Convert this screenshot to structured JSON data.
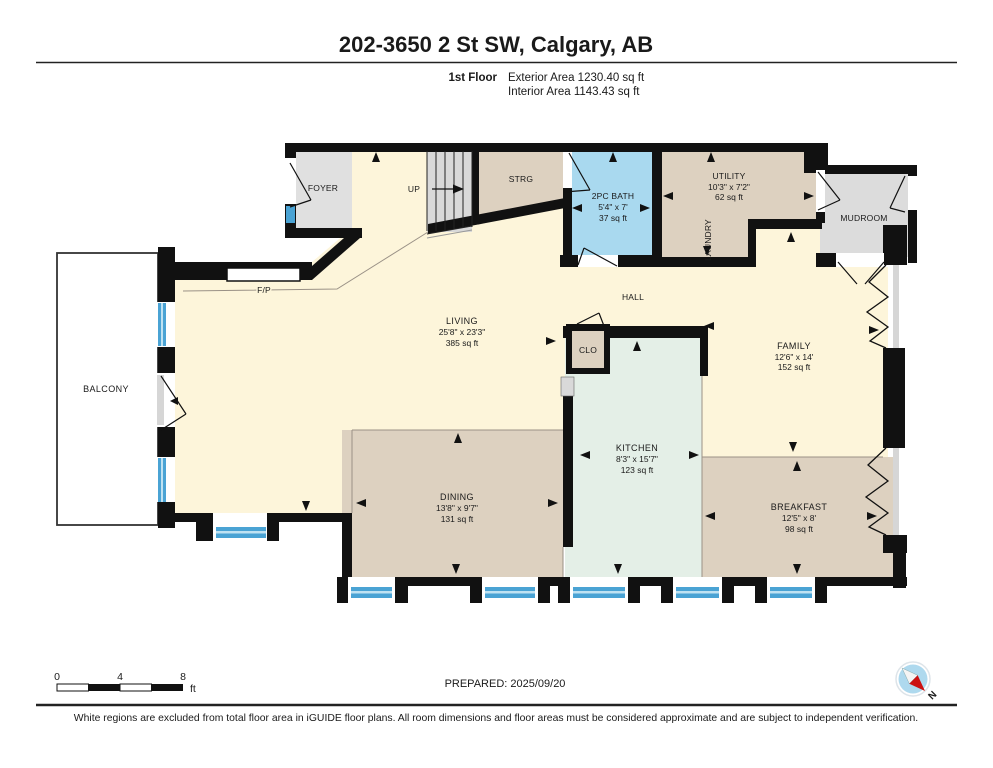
{
  "header": {
    "title": "202-3650 2 St SW, Calgary, AB",
    "floor_label": "1st Floor",
    "exterior_area": "Exterior Area 1230.40 sq ft",
    "interior_area": "Interior Area 1143.43 sq ft"
  },
  "rooms": {
    "foyer": {
      "name": "FOYER"
    },
    "up": {
      "name": "UP"
    },
    "strg": {
      "name": "STRG"
    },
    "bath": {
      "name": "2PC BATH",
      "dims": "5'4\" x 7'",
      "area": "37 sq ft"
    },
    "utility": {
      "name": "UTILITY",
      "dims": "10'3\" x 7'2\"",
      "area": "62 sq ft"
    },
    "laundry": {
      "name": "LAUNDRY"
    },
    "mudroom": {
      "name": "MUDROOM"
    },
    "fireplace": {
      "name": "F/P"
    },
    "hall": {
      "name": "HALL"
    },
    "living": {
      "name": "LIVING",
      "dims": "25'8\" x 23'3\"",
      "area": "385 sq ft"
    },
    "clo": {
      "name": "CLO"
    },
    "family": {
      "name": "FAMILY",
      "dims": "12'6\" x 14'",
      "area": "152 sq ft"
    },
    "kitchen": {
      "name": "KITCHEN",
      "dims": "8'3\" x 15'7\"",
      "area": "123 sq ft"
    },
    "dining": {
      "name": "DINING",
      "dims": "13'8\" x 9'7\"",
      "area": "131 sq ft"
    },
    "breakfast": {
      "name": "BREAKFAST",
      "dims": "12'5\" x 8'",
      "area": "98 sq ft"
    },
    "balcony": {
      "name": "BALCONY"
    }
  },
  "footer": {
    "scale": {
      "tick0": "0",
      "tick4": "4",
      "tick8": "8",
      "unit": "ft"
    },
    "prepared": "PREPARED: 2025/09/20",
    "compass_north": "N",
    "disclaimer": "White regions are excluded from total floor area in iGUIDE floor plans. All room dimensions and floor areas must be considered approximate and are subject to independent verification."
  },
  "colors": {
    "wall": "#111111",
    "cream_room": "#fdf5da",
    "tan_room": "#ddd1c0",
    "gray_room": "#e0e0e0",
    "bath_blue": "#a9d9ef",
    "kitchen_green": "#e4efe7",
    "window_blue": "#4aa3d4",
    "compass_blue": "#aed9ee",
    "compass_red": "#cc1111"
  }
}
